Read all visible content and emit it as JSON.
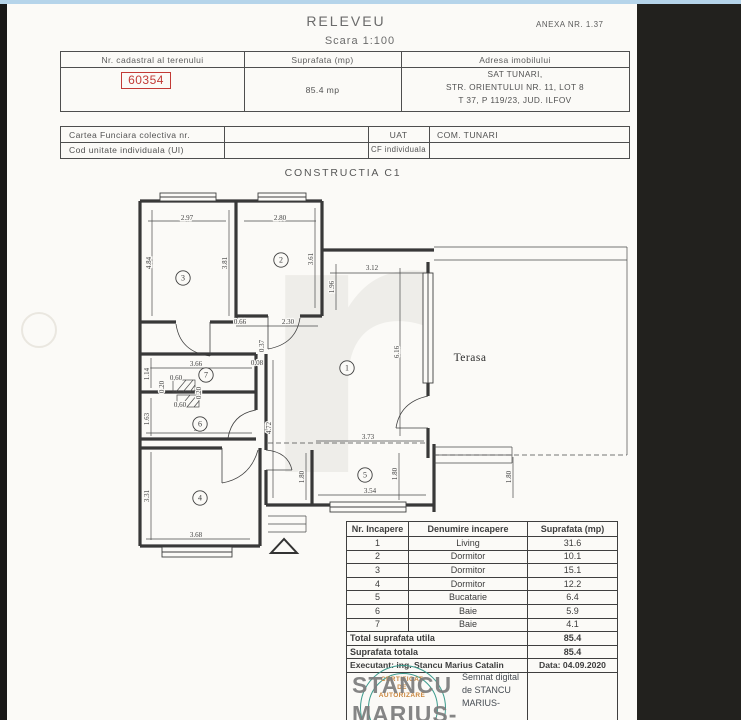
{
  "header": {
    "title": "RELEVEU",
    "scale": "Scara 1:100",
    "annex": "ANEXA NR. 1.37"
  },
  "cadastral_table": {
    "col_cadastral": "Nr. cadastral al terenului",
    "col_surface": "Suprafata (mp)",
    "col_address": "Adresa imobilului",
    "cadastral_number": "60354",
    "surface_value": "85.4 mp",
    "address_lines": [
      "SAT TUNARI,",
      "STR. ORIENTULUI NR. 11, LOT 8",
      "T 37, P 119/23, JUD. ILFOV"
    ]
  },
  "cf_table": {
    "row1_label": "Cartea Funciara colectiva nr.",
    "row1_key": "UAT",
    "row1_value": "COM. TUNARI",
    "row2_label": "Cod unitate individuala (UI)",
    "row2_key": "CF individuala",
    "row2_value": ""
  },
  "construction": {
    "title": "CONSTRUCTIA C1"
  },
  "floor_plan": {
    "terasa_label": "Terasa",
    "rooms": [
      {
        "n": "1",
        "x": 347,
        "y": 368
      },
      {
        "n": "2",
        "x": 281,
        "y": 260
      },
      {
        "n": "3",
        "x": 183,
        "y": 278
      },
      {
        "n": "4",
        "x": 200,
        "y": 498
      },
      {
        "n": "5",
        "x": 365,
        "y": 475
      },
      {
        "n": "6",
        "x": 200,
        "y": 424
      },
      {
        "n": "7",
        "x": 206,
        "y": 375
      }
    ],
    "dimensions": [
      {
        "t": "2.97",
        "x": 187,
        "y": 220,
        "r": 0
      },
      {
        "t": "2.80",
        "x": 280,
        "y": 220,
        "r": 0
      },
      {
        "t": "4.84",
        "x": 151,
        "y": 263,
        "r": 1
      },
      {
        "t": "3.81",
        "x": 227,
        "y": 263,
        "r": 1
      },
      {
        "t": "3.61",
        "x": 313,
        "y": 259,
        "r": 1
      },
      {
        "t": "0.66",
        "x": 240,
        "y": 324,
        "r": 0
      },
      {
        "t": "2.30",
        "x": 288,
        "y": 324,
        "r": 0
      },
      {
        "t": "3.12",
        "x": 372,
        "y": 270,
        "r": 0
      },
      {
        "t": "1.96",
        "x": 334,
        "y": 287,
        "r": 1
      },
      {
        "t": "6.16",
        "x": 399,
        "y": 352,
        "r": 1
      },
      {
        "t": "3.73",
        "x": 368,
        "y": 439,
        "r": 0
      },
      {
        "t": "3.66",
        "x": 196,
        "y": 366,
        "r": 0
      },
      {
        "t": "1.14",
        "x": 149,
        "y": 374,
        "r": 1
      },
      {
        "t": "0.37",
        "x": 264,
        "y": 346,
        "r": 1
      },
      {
        "t": "0.08",
        "x": 257,
        "y": 365,
        "r": 0
      },
      {
        "t": "0.60",
        "x": 176,
        "y": 380,
        "r": 0
      },
      {
        "t": "0.20",
        "x": 164,
        "y": 387,
        "r": 1
      },
      {
        "t": "0.60",
        "x": 180,
        "y": 407,
        "r": 0
      },
      {
        "t": "0.20",
        "x": 201,
        "y": 393,
        "r": 1
      },
      {
        "t": "1.63",
        "x": 149,
        "y": 419,
        "r": 1
      },
      {
        "t": "3.67",
        "x": 200,
        "y": 431,
        "r": 0
      },
      {
        "t": "4.72",
        "x": 271,
        "y": 428,
        "r": 1
      },
      {
        "t": "3.31",
        "x": 149,
        "y": 496,
        "r": 1
      },
      {
        "t": "3.68",
        "x": 196,
        "y": 537,
        "r": 0
      },
      {
        "t": "3.54",
        "x": 370,
        "y": 493,
        "r": 0
      },
      {
        "t": "1.80",
        "x": 304,
        "y": 477,
        "r": 1
      },
      {
        "t": "1.80",
        "x": 397,
        "y": 474,
        "r": 1
      },
      {
        "t": "1.80",
        "x": 511,
        "y": 477,
        "r": 1
      }
    ]
  },
  "room_table": {
    "headers": [
      "Nr. Incapere",
      "Denumire incapere",
      "Suprafata (mp)"
    ],
    "rows": [
      [
        "1",
        "Living",
        "31.6"
      ],
      [
        "2",
        "Dormitor",
        "10.1"
      ],
      [
        "3",
        "Dormitor",
        "15.1"
      ],
      [
        "4",
        "Dormitor",
        "12.2"
      ],
      [
        "5",
        "Bucatarie",
        "6.4"
      ],
      [
        "6",
        "Baie",
        "5.9"
      ],
      [
        "7",
        "Baie",
        "4.1"
      ]
    ],
    "total_utila_label": "Total suprafata utila",
    "total_utila_value": "85.4",
    "total_label": "Suprafata totala",
    "total_value": "85.4",
    "executant": "Executant: ing. Stancu Marius Catalin",
    "date": "Data: 04.09.2020"
  },
  "signature": {
    "name_line1": "STANCU",
    "name_line2": "MARIUS-",
    "digital_lines": [
      "Semnat digital",
      "de STANCU",
      "MARIUS-"
    ],
    "stamp_lines": [
      "CERTIFICAT",
      "DE",
      "AUTORIZARE"
    ]
  },
  "colors": {
    "cadastral_red": "#c23a36",
    "stamp_teal": "#3a9a8c",
    "stamp_orange": "#c9853c",
    "top_strip_blue": "#b5d4ea"
  }
}
